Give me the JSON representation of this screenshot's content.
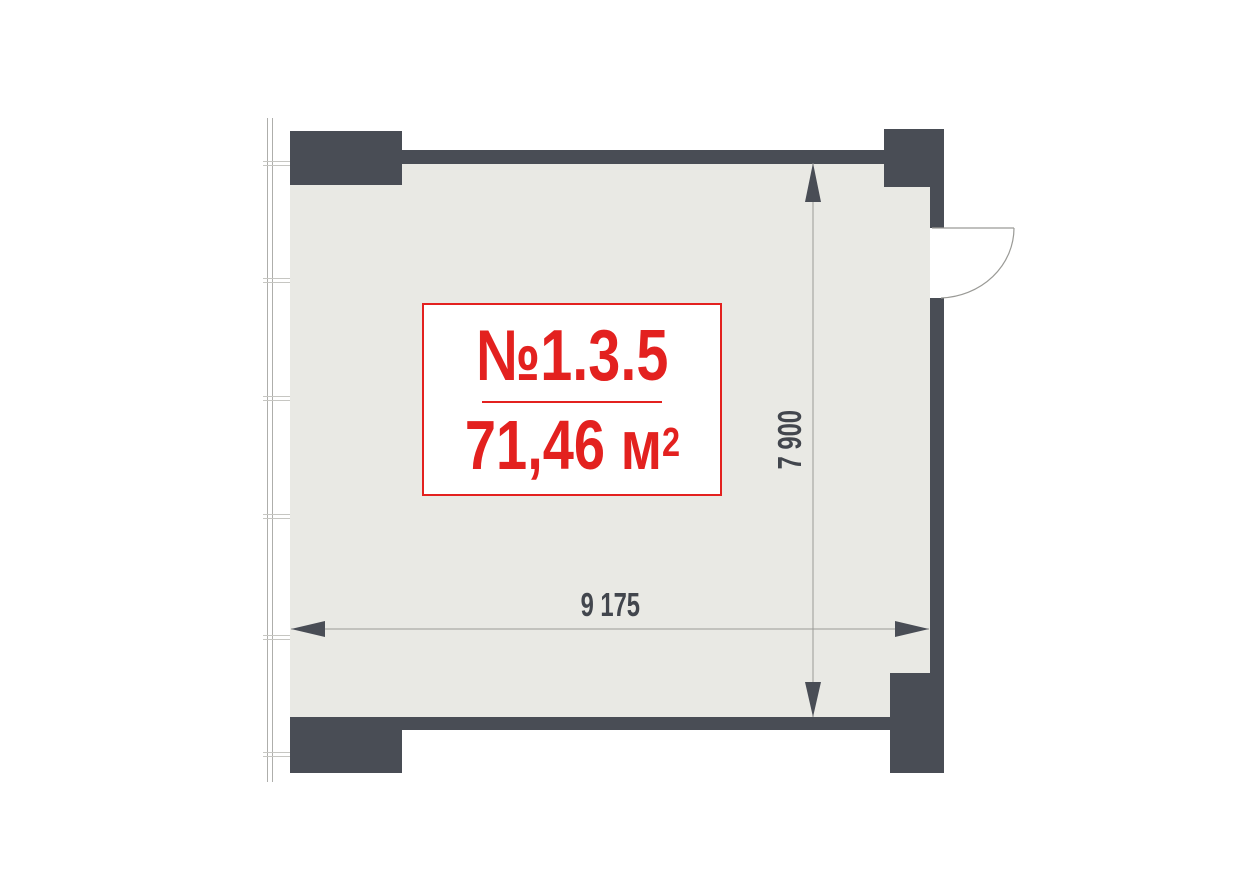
{
  "unit": {
    "number": "№1.3.5",
    "area_value": "71,46",
    "area_unit": " м",
    "area_exponent": "2"
  },
  "dimensions": {
    "width": "9 175",
    "height": "7 900"
  },
  "icons": {
    "door": "door-swing-icon",
    "arrows": [
      "dim-arrow-left-icon",
      "dim-arrow-right-icon",
      "dim-arrow-up-icon",
      "dim-arrow-down-icon"
    ]
  },
  "colors": {
    "wall": "#494d55",
    "floor": "#e9e9e4",
    "accent": "#e3211f",
    "dim_text": "#42464d",
    "line": "#9a9a96",
    "window_line": "#aeaeab",
    "tick_line": "#c6c6c2",
    "background": "#ffffff"
  }
}
